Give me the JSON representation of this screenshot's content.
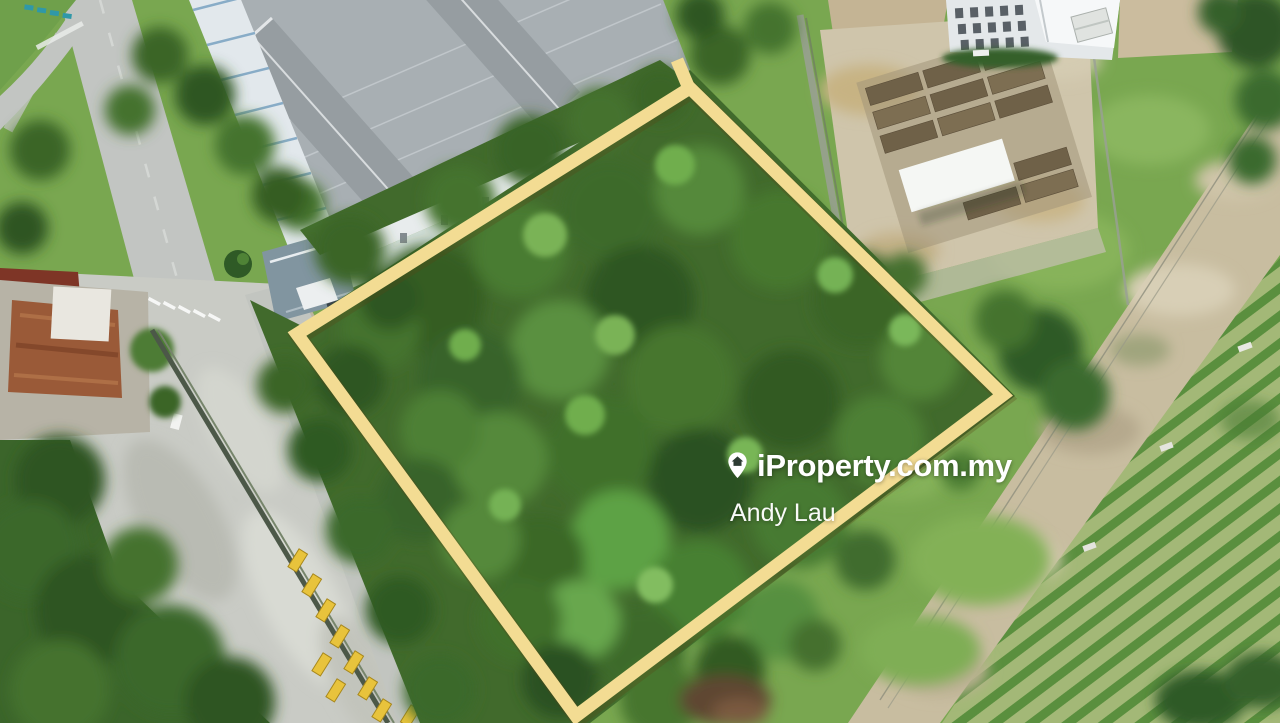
{
  "photo": {
    "type": "aerial-drone-photograph",
    "subject": "Vacant forested land parcel outlined in yellow beside an industrial warehouse, a water-treatment facility and crop plantation rows"
  },
  "watermark": {
    "brand": "iProperty.com.my",
    "icon": "location-pin-house-icon",
    "agent_name": "Andy Lau",
    "text_color": "#ffffff"
  },
  "boundary": {
    "points": "690,88 1003,395 576,716 297,334",
    "stroke_color": "#f3dc93",
    "stroke_width": 13
  },
  "palette": {
    "boundary_yellow": "#f3dc93",
    "forest_green": "#416a2c",
    "grass_green": "#7dab53",
    "road_gray": "#c2c5c2",
    "yard_concrete": "#c9cbc5",
    "warehouse_roof": "#a8afb3",
    "skylight_blue": "#7fa6c4",
    "farm_row_green": "#5a8f3e",
    "soil_tan": "#c8bda0",
    "rust_roof": "#9a5a38",
    "trailer_yellow": "#e8c33c"
  }
}
